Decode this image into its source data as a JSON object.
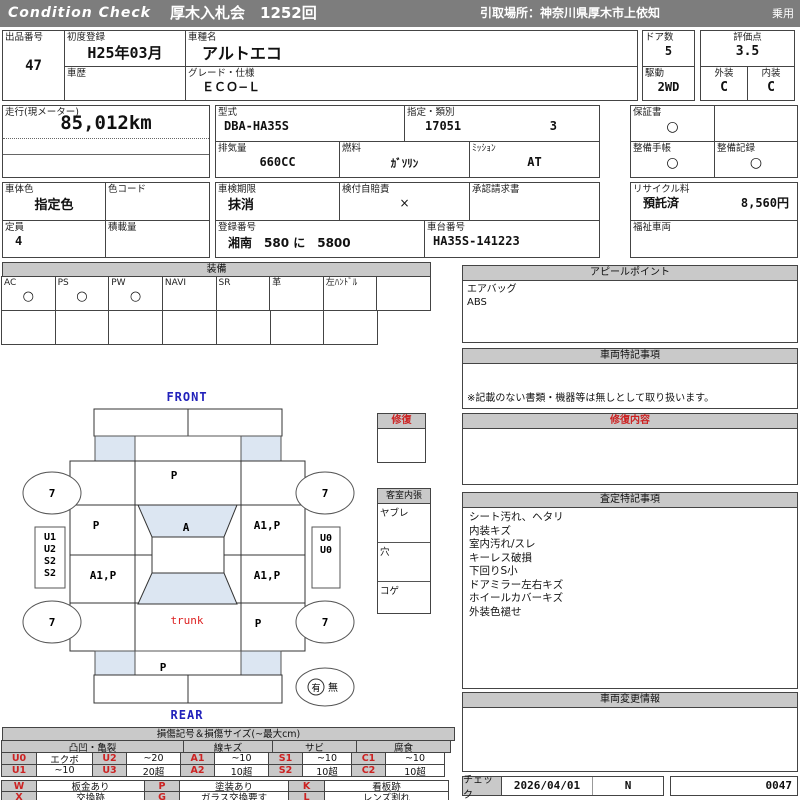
{
  "header": {
    "brand": "Condition  Check",
    "auction": "厚木入札会　1252回",
    "pickup": "引取場所：神奈川県厚木市上依知",
    "category": "乗用"
  },
  "info": {
    "lot_label": "出品番号",
    "lot_value": "47",
    "first_reg_label": "初度登録",
    "first_reg_value": "H25年03月",
    "history_label": "車歴",
    "history_value": "",
    "model_name_label": "車種名",
    "model_name_value": "アルトエコ",
    "grade_label": "グレード・仕様",
    "grade_value": "ＥＣＯ−Ｌ",
    "doors_label": "ドア数",
    "doors_value": "5",
    "score_label": "評価点",
    "score_value": "3.5",
    "drive_label": "駆動",
    "drive_value": "2WD",
    "exterior_label": "外装",
    "exterior_value": "C",
    "interior_label": "内装",
    "interior_value": "C",
    "mileage_label": "走行(現メーター)",
    "mileage_value": "85,012km",
    "model_code_label": "型式",
    "model_code_value": "DBA-HA35S",
    "class_label": "指定・類別",
    "class_value1": "17051",
    "class_value2": "3",
    "displacement_label": "排気量",
    "displacement_value": "660CC",
    "fuel_label": "燃料",
    "fuel_value": "ｶﾞｿﾘﾝ",
    "mission_label": "ﾐｯｼｮﾝ",
    "mission_value": "AT",
    "warranty_label": "保証書",
    "warranty_value": "○",
    "maint_book_label": "整備手帳",
    "maint_book_value": "○",
    "maint_rec_label": "整備記録",
    "maint_rec_value": "○",
    "body_color_label": "車体色",
    "body_color_value": "指定色",
    "color_code_label": "色コード",
    "color_code_value": "",
    "capacity_label": "定員",
    "capacity_value": "4",
    "load_label": "積載量",
    "load_value": "",
    "inspection_label": "車検期限",
    "inspection_value": "抹消",
    "insurance_label": "検付自賠責",
    "insurance_value": "×",
    "approval_label": "承認請求書",
    "approval_value": "",
    "reg_number_label": "登録番号",
    "reg_number_value": "湘南　580 に　5800",
    "chassis_label": "車台番号",
    "chassis_value": "HA35S-141223",
    "recycle_label": "リサイクル料",
    "recycle_status": "預託済",
    "recycle_fee": "8,560円",
    "welfare_label": "福祉車両",
    "welfare_value": ""
  },
  "equipment": {
    "title": "装備",
    "items": [
      {
        "label": "AC",
        "value": "○"
      },
      {
        "label": "PS",
        "value": "○"
      },
      {
        "label": "PW",
        "value": "○"
      },
      {
        "label": "NAVI",
        "value": ""
      },
      {
        "label": "SR",
        "value": ""
      },
      {
        "label": "革",
        "value": ""
      },
      {
        "label": "左ﾊﾝﾄﾞﾙ",
        "value": ""
      },
      {
        "label": "",
        "value": ""
      }
    ]
  },
  "panels": {
    "appeal": {
      "title": "アピールポイント",
      "lines": "エアバッグ\nABS"
    },
    "special": {
      "title": "車両特記事項",
      "note": "※記載のない書類・機器等は無しとして取り扱います。"
    },
    "repair": {
      "title": "修復内容",
      "body": ""
    },
    "assessment": {
      "title": "査定特記事項",
      "lines": "シート汚れ、ヘタリ\n内装キズ\n室内汚れ/スレ\nキーレス破損\n下回りS小\nドアミラー左右キズ\nホイールカバーキズ\n外装色褪せ"
    },
    "change": {
      "title": "車両変更情報",
      "body": ""
    },
    "check": {
      "label": "チェック",
      "date": "2026/04/01",
      "flag": "N",
      "number": "0047"
    }
  },
  "diagram": {
    "front_label": "FRONT",
    "rear_label": "REAR",
    "panels": {
      "hood": "P",
      "windshield": "A",
      "front_left_door": "P",
      "front_right_door": "A1,P",
      "rear_left_door": "A1,P",
      "rear_right_door": "A1,P",
      "rear_right_fender": "P",
      "rear_panel": "P",
      "trunk": "trunk"
    },
    "tires": {
      "front_left": "7",
      "front_right": "7",
      "rear_left": "7",
      "rear_right": "7"
    },
    "left_marks": [
      "U1",
      "U2",
      "S2",
      "S2"
    ],
    "right_marks": [
      "U0",
      "U0"
    ],
    "presence": {
      "has": "有",
      "none": "無"
    },
    "repair_legend": {
      "title": "修復"
    },
    "cabin_legend": {
      "title": "客室内張",
      "rows": [
        "ヤブレ",
        "穴",
        "コゲ"
      ]
    }
  },
  "damage_legend": {
    "title": "損傷記号＆損傷サイズ(~最大cm)",
    "groups": [
      "凸凹・亀裂",
      "線キズ",
      "サビ",
      "腐食"
    ],
    "row1": [
      {
        "code": "U0",
        "val": "エクボ"
      },
      {
        "code": "U2",
        "val": "~20"
      },
      {
        "code": "A1",
        "val": "~10"
      },
      {
        "code": "S1",
        "val": "~10"
      },
      {
        "code": "C1",
        "val": "~10"
      }
    ],
    "row2": [
      {
        "code": "U1",
        "val": "~10"
      },
      {
        "code": "U3",
        "val": "20超"
      },
      {
        "code": "A2",
        "val": "10超"
      },
      {
        "code": "S2",
        "val": "10超"
      },
      {
        "code": "C2",
        "val": "10超"
      }
    ],
    "marks1": [
      {
        "code": "W",
        "val": "板金あり"
      },
      {
        "code": "P",
        "val": "塗装あり"
      },
      {
        "code": "K",
        "val": "看板跡"
      }
    ],
    "marks2": [
      {
        "code": "X",
        "val": "交換跡"
      },
      {
        "code": "G",
        "val": "ガラス交換要す"
      },
      {
        "code": "L",
        "val": "レンズ割れ"
      }
    ]
  }
}
